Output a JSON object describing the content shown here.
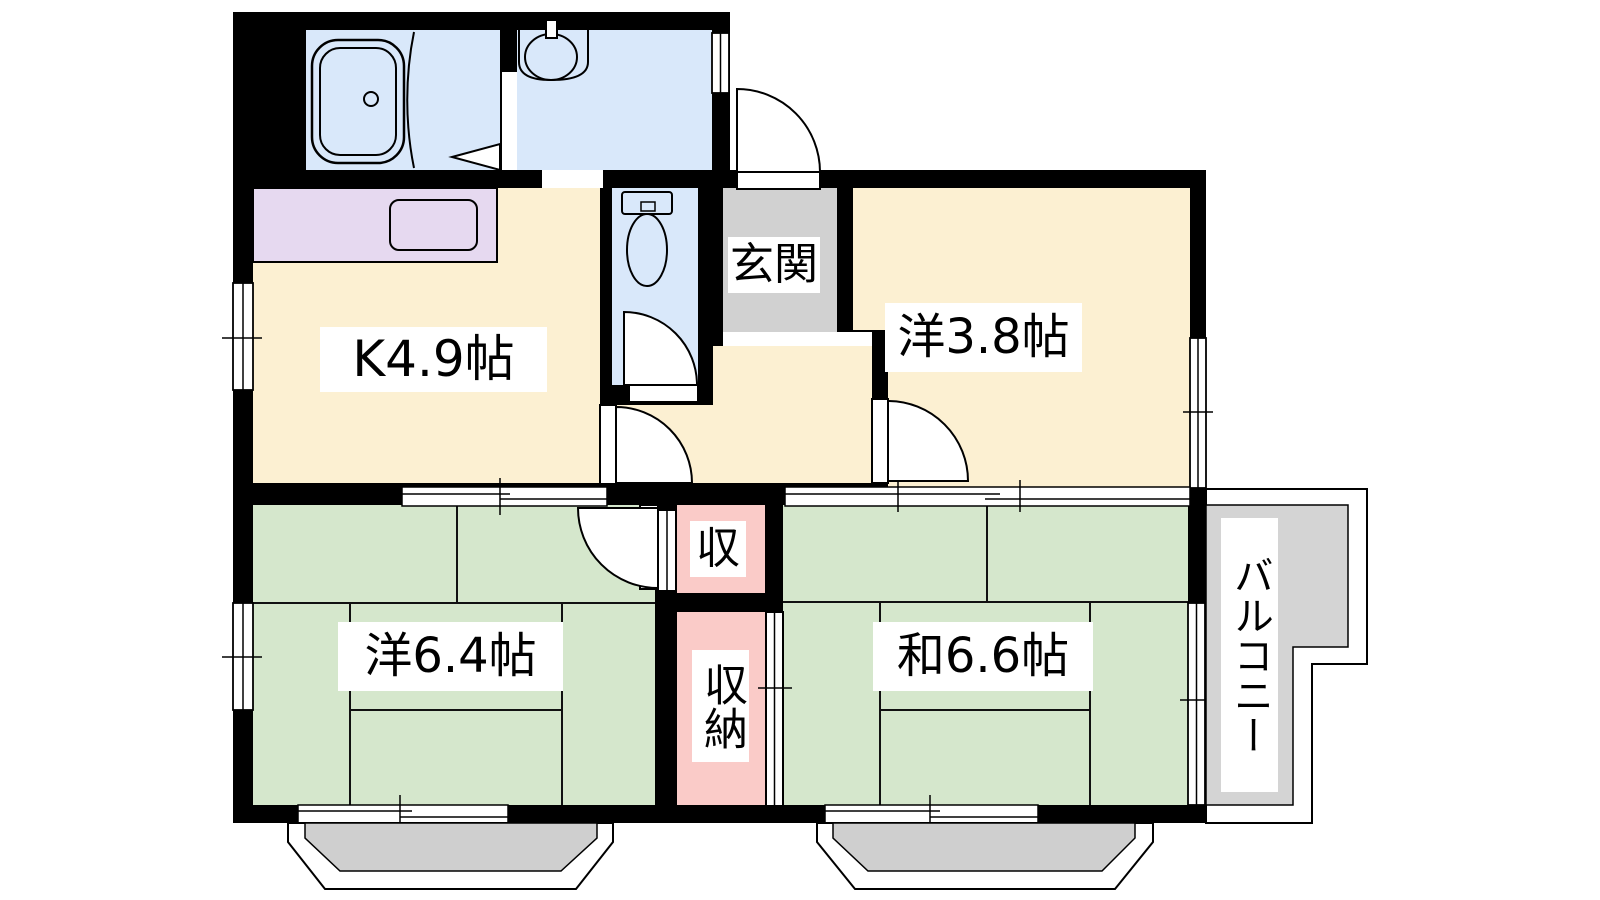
{
  "floor_plan": {
    "type": "japanese-apartment-floorplan",
    "rooms": [
      {
        "id": "kitchen",
        "label": "K4.9帖",
        "size_jo": 4.9,
        "kind": "kitchen"
      },
      {
        "id": "entrance",
        "label": "玄関",
        "kind": "entrance"
      },
      {
        "id": "western-room-1",
        "label": "洋3.8帖",
        "size_jo": 3.8,
        "kind": "western-room"
      },
      {
        "id": "western-room-2",
        "label": "洋6.4帖",
        "size_jo": 6.4,
        "kind": "western-room"
      },
      {
        "id": "japanese-room",
        "label": "和6.6帖",
        "size_jo": 6.6,
        "kind": "japanese-room"
      },
      {
        "id": "closet",
        "label": "収",
        "kind": "closet"
      },
      {
        "id": "storage",
        "label": "収納",
        "kind": "closet"
      },
      {
        "id": "balcony",
        "label": "バルコニー",
        "kind": "balcony"
      }
    ],
    "fixtures": [
      {
        "name": "bathtub-icon"
      },
      {
        "name": "washbasin-icon"
      },
      {
        "name": "toilet-icon"
      },
      {
        "name": "kitchen-sink-icon"
      },
      {
        "name": "kitchen-counter"
      }
    ],
    "colors": {
      "background": "#FFFFFF",
      "wall-black": "#000000",
      "wet-area-blue": "#D9E8FA",
      "flooring-cream": "#FCF0D2",
      "counter-purple": "#E6D9F0",
      "entrance-gray": "#D1D1D1",
      "room-green": "#D5E7CC",
      "closet-pink": "#FACBC8",
      "balcony-gray": "#D4D4D4",
      "bay-window-gray": "#CFCFCF"
    }
  }
}
